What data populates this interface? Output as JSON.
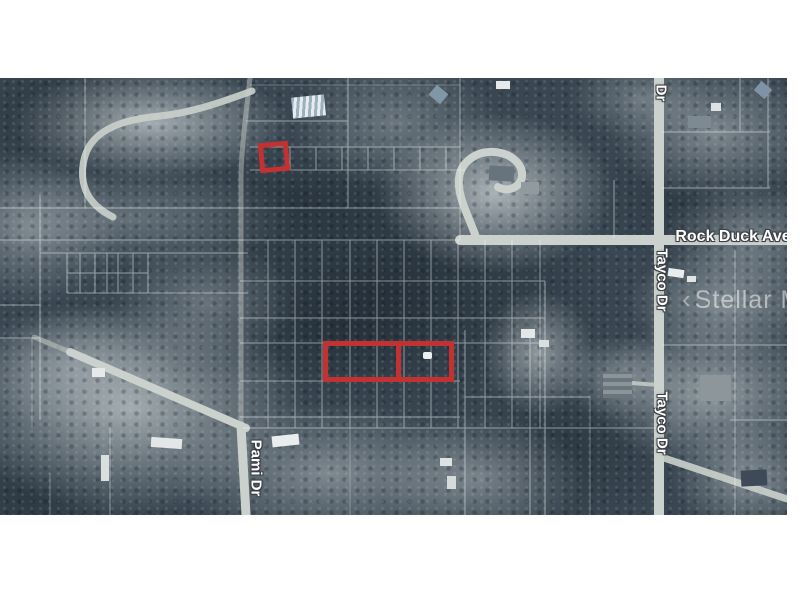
{
  "image": {
    "kind": "aerial-parcel-map-photo",
    "letterbox_background": "#ffffff"
  },
  "street_labels": {
    "rock_duck_ave": "Rock Duck Ave",
    "tayco_dr_top": "Dr",
    "tayco_dr_mid": "Tayco Dr",
    "tayco_dr_lower": "Tayco Dr",
    "pami_dr": "Pami Dr"
  },
  "watermark": {
    "chevron": "‹",
    "text": "Stellar MLS"
  },
  "parcels": {
    "highlighted_count": 3,
    "outline_color": "#c33131"
  },
  "colors": {
    "forest": "#3a4752",
    "cleared_land": "#b6bfc3",
    "road": "#cbd1cc",
    "grid_line": "rgba(240,245,245,0.5)",
    "label_text": "#ffffff",
    "label_outline": "#3a3f44"
  }
}
